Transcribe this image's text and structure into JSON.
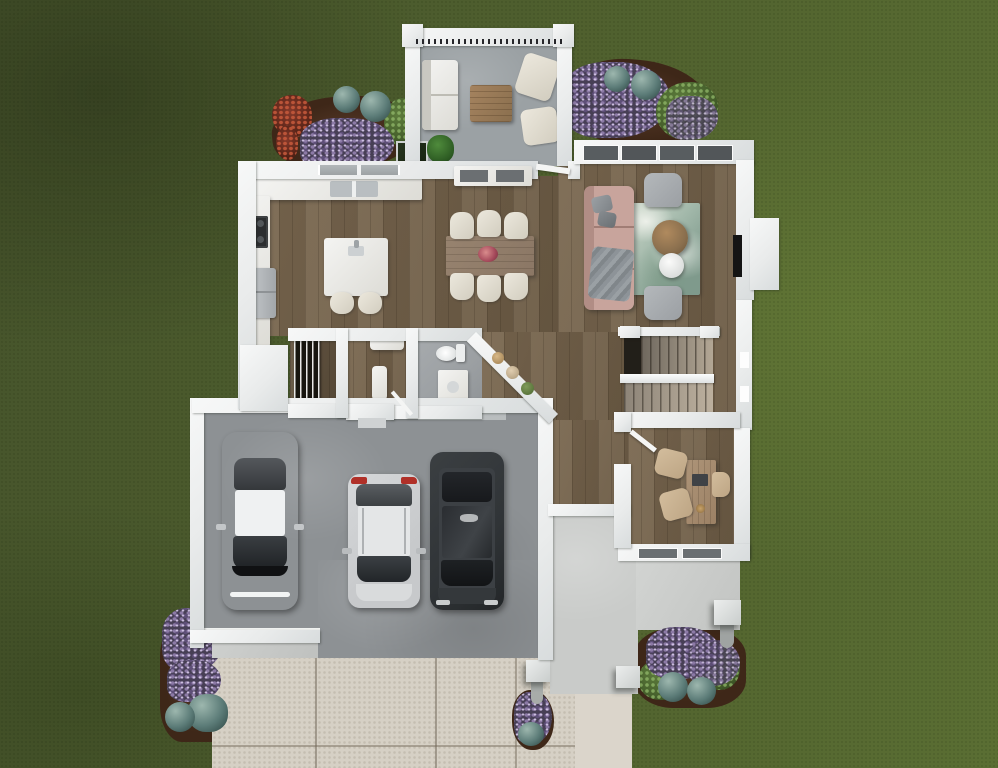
{
  "scene": {
    "type": "floor-plan-rendering",
    "view": "top-down-overhead",
    "setting": "house on green lawn with driveway, rear deck, patio and flower beds",
    "visible_text": "none"
  },
  "colors": {
    "grass_base": "#4e5e2e",
    "grass_dark": "#46542b",
    "grass_light": "#5a6e33",
    "wall": "#e9ebeb",
    "wood": "#7a6850",
    "wood_dark": "#6b5a44",
    "porch_floor": "#9ba1a4",
    "garage_floor": "#8d9194",
    "driveway": "#d6d0c5",
    "walkway": "#dbd5cb",
    "patio": "#c9cbc9",
    "tile": "#9b9fa2",
    "mulch": "#553827",
    "flowers_purple": "#8c7aa6",
    "bush_teal": "#5c7c78",
    "bush_green": "#46602c",
    "bush_red": "#86392a",
    "sofa_blush": "#c8a49c",
    "rug_teal": "#a2b8aa",
    "armchair_gray": "#9b9fa3",
    "seat_cream": "#ece8dd",
    "table_wood": "#8a6f4e",
    "dining_wood": "#8b7765",
    "stairs_light": "#b3a795",
    "stairs_dark": "#6e675d",
    "desk_wood": "#9c8165",
    "chair_tan": "#bda584",
    "car_white": "#dfe1e2",
    "car_silver": "#c7c9cb",
    "car_black": "#303437",
    "taillight_red": "#b03028",
    "glass_dark": "#2e3134",
    "appliance_gray": "#b7bbbe",
    "fireplace_black": "#141414"
  },
  "rooms": [
    {
      "id": "rear-deck",
      "position": "top-center",
      "features": [
        "railing-with-balusters",
        "outdoor-sofa",
        "square-coffee-table",
        "armchair",
        "armchair",
        "potted-plant",
        "planter-box"
      ]
    },
    {
      "id": "kitchen",
      "position": "upper-left",
      "features": [
        "l-shaped-counter",
        "double-sink",
        "window-over-sink",
        "cooktop",
        "refrigerator",
        "island-with-faucet",
        "stool",
        "stool"
      ]
    },
    {
      "id": "dining-area",
      "position": "top-center",
      "features": [
        "rectangular-table",
        "six-chairs",
        "floral-centerpiece",
        "console-cabinet"
      ]
    },
    {
      "id": "living-room",
      "position": "upper-right",
      "features": [
        "four-windows",
        "sectional-sofa-blush",
        "throw-blanket",
        "pillows",
        "marble-pattern-rug",
        "round-wood-coffee-table",
        "round-side-table",
        "armchair",
        "armchair",
        "fireplace-with-bump-out"
      ]
    },
    {
      "id": "pantry",
      "position": "center-left",
      "features": [
        "tall-shelving-unit"
      ]
    },
    {
      "id": "mudroom",
      "position": "center",
      "features": [
        "bench",
        "bench",
        "door-to-garage"
      ]
    },
    {
      "id": "powder-bath",
      "position": "center",
      "features": [
        "toilet",
        "vanity-sink",
        "door"
      ]
    },
    {
      "id": "display-nook",
      "position": "center",
      "features": [
        "diagonal-wall-shelf",
        "baskets-and-plants"
      ]
    },
    {
      "id": "staircase",
      "position": "center-right",
      "features": [
        "u-shaped-two-flights",
        "landing",
        "white-handrail"
      ]
    },
    {
      "id": "office",
      "position": "lower-right",
      "features": [
        "desk",
        "desk-chair",
        "guest-chair",
        "guest-chair",
        "door",
        "two-windows"
      ]
    },
    {
      "id": "garage",
      "position": "lower-left",
      "features": [
        "three-parked-cars",
        "door-to-mudroom"
      ]
    },
    {
      "id": "rear-patio",
      "position": "bottom-right",
      "features": [
        "three-square-posts",
        "door-threshold"
      ]
    },
    {
      "id": "driveway",
      "position": "bottom",
      "features": [
        "expansion-joints",
        "garage-apron",
        "side-walkway"
      ]
    }
  ],
  "vehicles": [
    {
      "id": "sedan",
      "color_name": "white",
      "facing": "down",
      "stall": "left"
    },
    {
      "id": "compact-suv",
      "color_name": "silver",
      "facing": "down",
      "stall": "middle",
      "detail": "red-taillights-at-top"
    },
    {
      "id": "large-suv",
      "color_name": "black",
      "facing": "down",
      "stall": "right"
    }
  ],
  "landscaping": [
    {
      "id": "bed-top-left",
      "plants": [
        "red-shrub",
        "purple-flowers",
        "teal-globe-bush",
        "teal-globe-bush",
        "green-foliage"
      ],
      "ground": "mulch"
    },
    {
      "id": "bed-top-right",
      "plants": [
        "purple-flowers",
        "teal-globe-bush",
        "teal-globe-bush",
        "green-fern"
      ],
      "ground": "mulch"
    },
    {
      "id": "bed-bottom-left",
      "plants": [
        "purple-flowers",
        "purple-flowers",
        "teal-plants"
      ],
      "ground": "mulch"
    },
    {
      "id": "bed-bottom-right",
      "plants": [
        "purple-flowers",
        "green-bushes",
        "teal-globe-bush",
        "teal-globe-bush"
      ],
      "ground": "mulch"
    },
    {
      "id": "bed-driveway-mid",
      "plants": [
        "purple-flowers",
        "teal-plant"
      ],
      "ground": "mulch"
    }
  ]
}
